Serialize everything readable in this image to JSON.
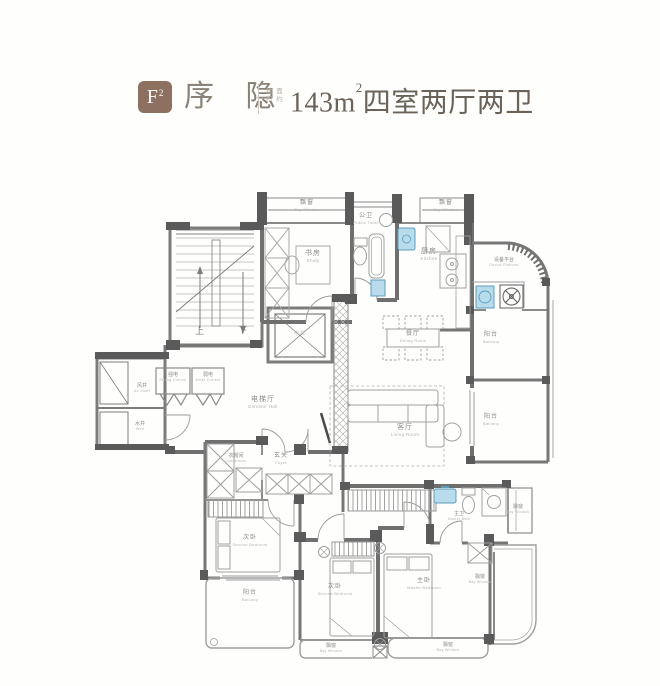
{
  "header": {
    "unit_badge": "F",
    "unit_badge_sup": "2",
    "title": "序 隐",
    "area_note_line1": "建 面",
    "area_note_line2": "积 约",
    "area_value": "143m",
    "area_sup": "2",
    "area_desc": "四室两厅两卫"
  },
  "floorplan": {
    "labels": [
      {
        "id": "bay-window-top-left",
        "zh": "飘窗",
        "en": "Bay Window"
      },
      {
        "id": "study",
        "zh": "书房",
        "en": "Study"
      },
      {
        "id": "public-bath",
        "zh": "公卫",
        "en": "Public Toilet"
      },
      {
        "id": "bay-window-top-right",
        "zh": "飘窗",
        "en": "Bay Window"
      },
      {
        "id": "kitchen",
        "zh": "厨房",
        "en": "Kitchen"
      },
      {
        "id": "device-platform",
        "zh": "设备平台",
        "en": "Device Platform"
      },
      {
        "id": "balcony-upper-right",
        "zh": "阳台",
        "en": "Balcony"
      },
      {
        "id": "balcony-lower-right",
        "zh": "阳台",
        "en": "Balcony"
      },
      {
        "id": "dining-room",
        "zh": "餐厅",
        "en": "Dining Room"
      },
      {
        "id": "living-room",
        "zh": "客厅",
        "en": "Living Room"
      },
      {
        "id": "elevator-hall",
        "zh": "电梯厅",
        "en": "Elevator Hall"
      },
      {
        "id": "elevator",
        "zh": "电梯",
        "en": ""
      },
      {
        "id": "air-shaft",
        "zh": "风井",
        "en": "Air Shaft"
      },
      {
        "id": "water-shaft",
        "zh": "水井",
        "en": "Well"
      },
      {
        "id": "strong-current",
        "zh": "强电",
        "en": "Strong Current"
      },
      {
        "id": "weak-current",
        "zh": "弱电",
        "en": "Weak Current"
      },
      {
        "id": "foyer",
        "zh": "玄关",
        "en": "Foyer"
      },
      {
        "id": "cloakroom",
        "zh": "衣帽间",
        "en": "Cloakroom"
      },
      {
        "id": "second-bedroom-west",
        "zh": "次卧",
        "en": "Second Bedroom"
      },
      {
        "id": "balcony-southwest",
        "zh": "阳台",
        "en": "Balcony"
      },
      {
        "id": "second-bedroom-south",
        "zh": "次卧",
        "en": "Second Bedroom"
      },
      {
        "id": "master-bedroom",
        "zh": "主卧",
        "en": "Master Bedroom"
      },
      {
        "id": "master-bath",
        "zh": "主卫",
        "en": "Master Bath"
      },
      {
        "id": "bay-window-east-small",
        "zh": "飘窗",
        "en": "Bay Window"
      },
      {
        "id": "bay-window-east",
        "zh": "飘窗",
        "en": "Bay Window"
      },
      {
        "id": "bay-window-south-left",
        "zh": "飘窗",
        "en": "Bay Window"
      },
      {
        "id": "bay-window-south-right",
        "zh": "飘窗",
        "en": "Bay Window"
      },
      {
        "id": "stairs-up",
        "zh": "上",
        "en": ""
      },
      {
        "id": "stairs-down",
        "zh": "下",
        "en": ""
      }
    ]
  },
  "colors": {
    "badge_brown": "#8d7060",
    "title_gray": "#8a8276",
    "wall_gray": "#6f6f6f",
    "fixture_blue": "#b8dcec"
  }
}
